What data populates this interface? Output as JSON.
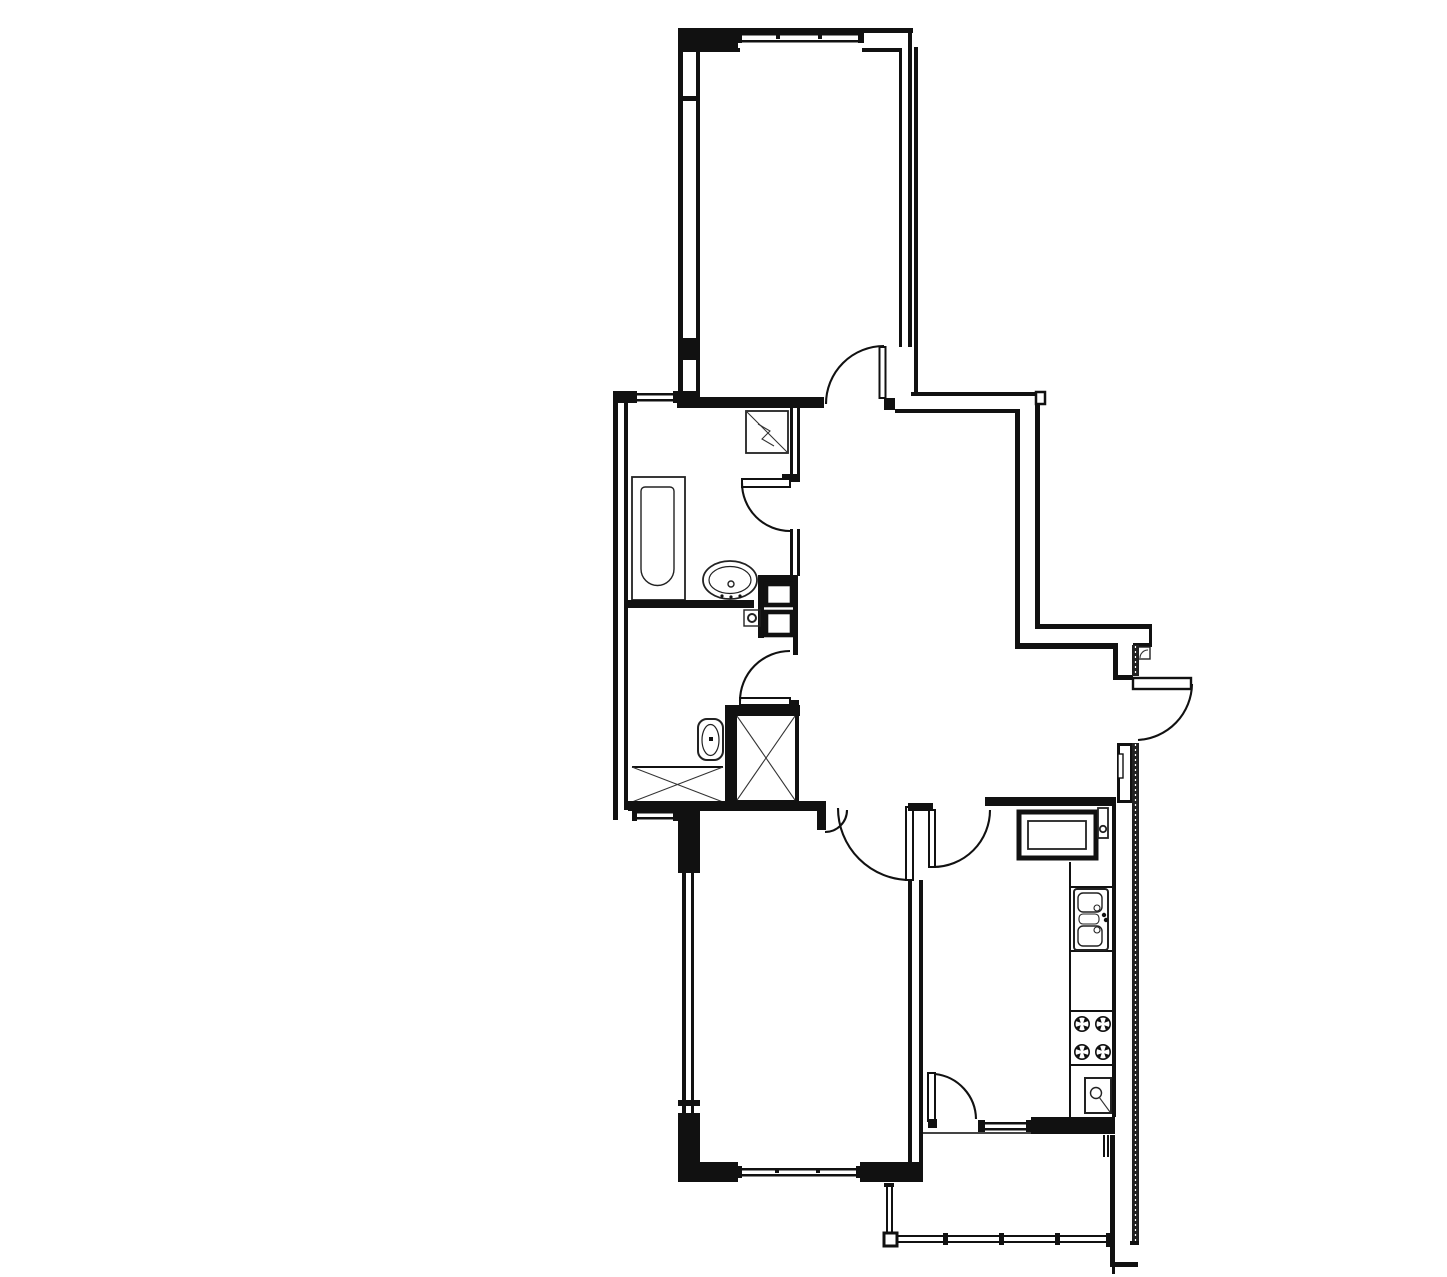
{
  "plan": {
    "type": "apartment floor plan",
    "background_color": "#ffffff",
    "wall_color": "#111111",
    "rooms": [
      {
        "id": "room-top",
        "kind": "room"
      },
      {
        "id": "bathroom",
        "kind": "wet-room"
      },
      {
        "id": "wc",
        "kind": "wet-room"
      },
      {
        "id": "hallway",
        "kind": "circulation"
      },
      {
        "id": "room-bottom",
        "kind": "room"
      },
      {
        "id": "kitchen",
        "kind": "kitchen"
      },
      {
        "id": "balcony",
        "kind": "balcony"
      }
    ],
    "fixtures": [
      "bathtub",
      "wash-basin",
      "corner-shower",
      "toilet",
      "ventilation-shaft-upper",
      "ventilation-shaft-lower",
      "crossed-storage-box",
      "floor-crossed-area",
      "kitchen-cabinet",
      "gas-meter",
      "kitchen-sink",
      "gas-stove",
      "water-heater"
    ],
    "stove_burner_count": 4,
    "doors": [
      "top-room-door",
      "bathroom-door",
      "wc-door",
      "bottom-room-door",
      "kitchen-door",
      "balcony-door",
      "entrance-door"
    ],
    "windows": [
      "top-room-window",
      "bathroom-vent-window-top",
      "bathroom-vent-window-bottom",
      "bottom-room-window",
      "kitchen-balcony-window"
    ]
  }
}
